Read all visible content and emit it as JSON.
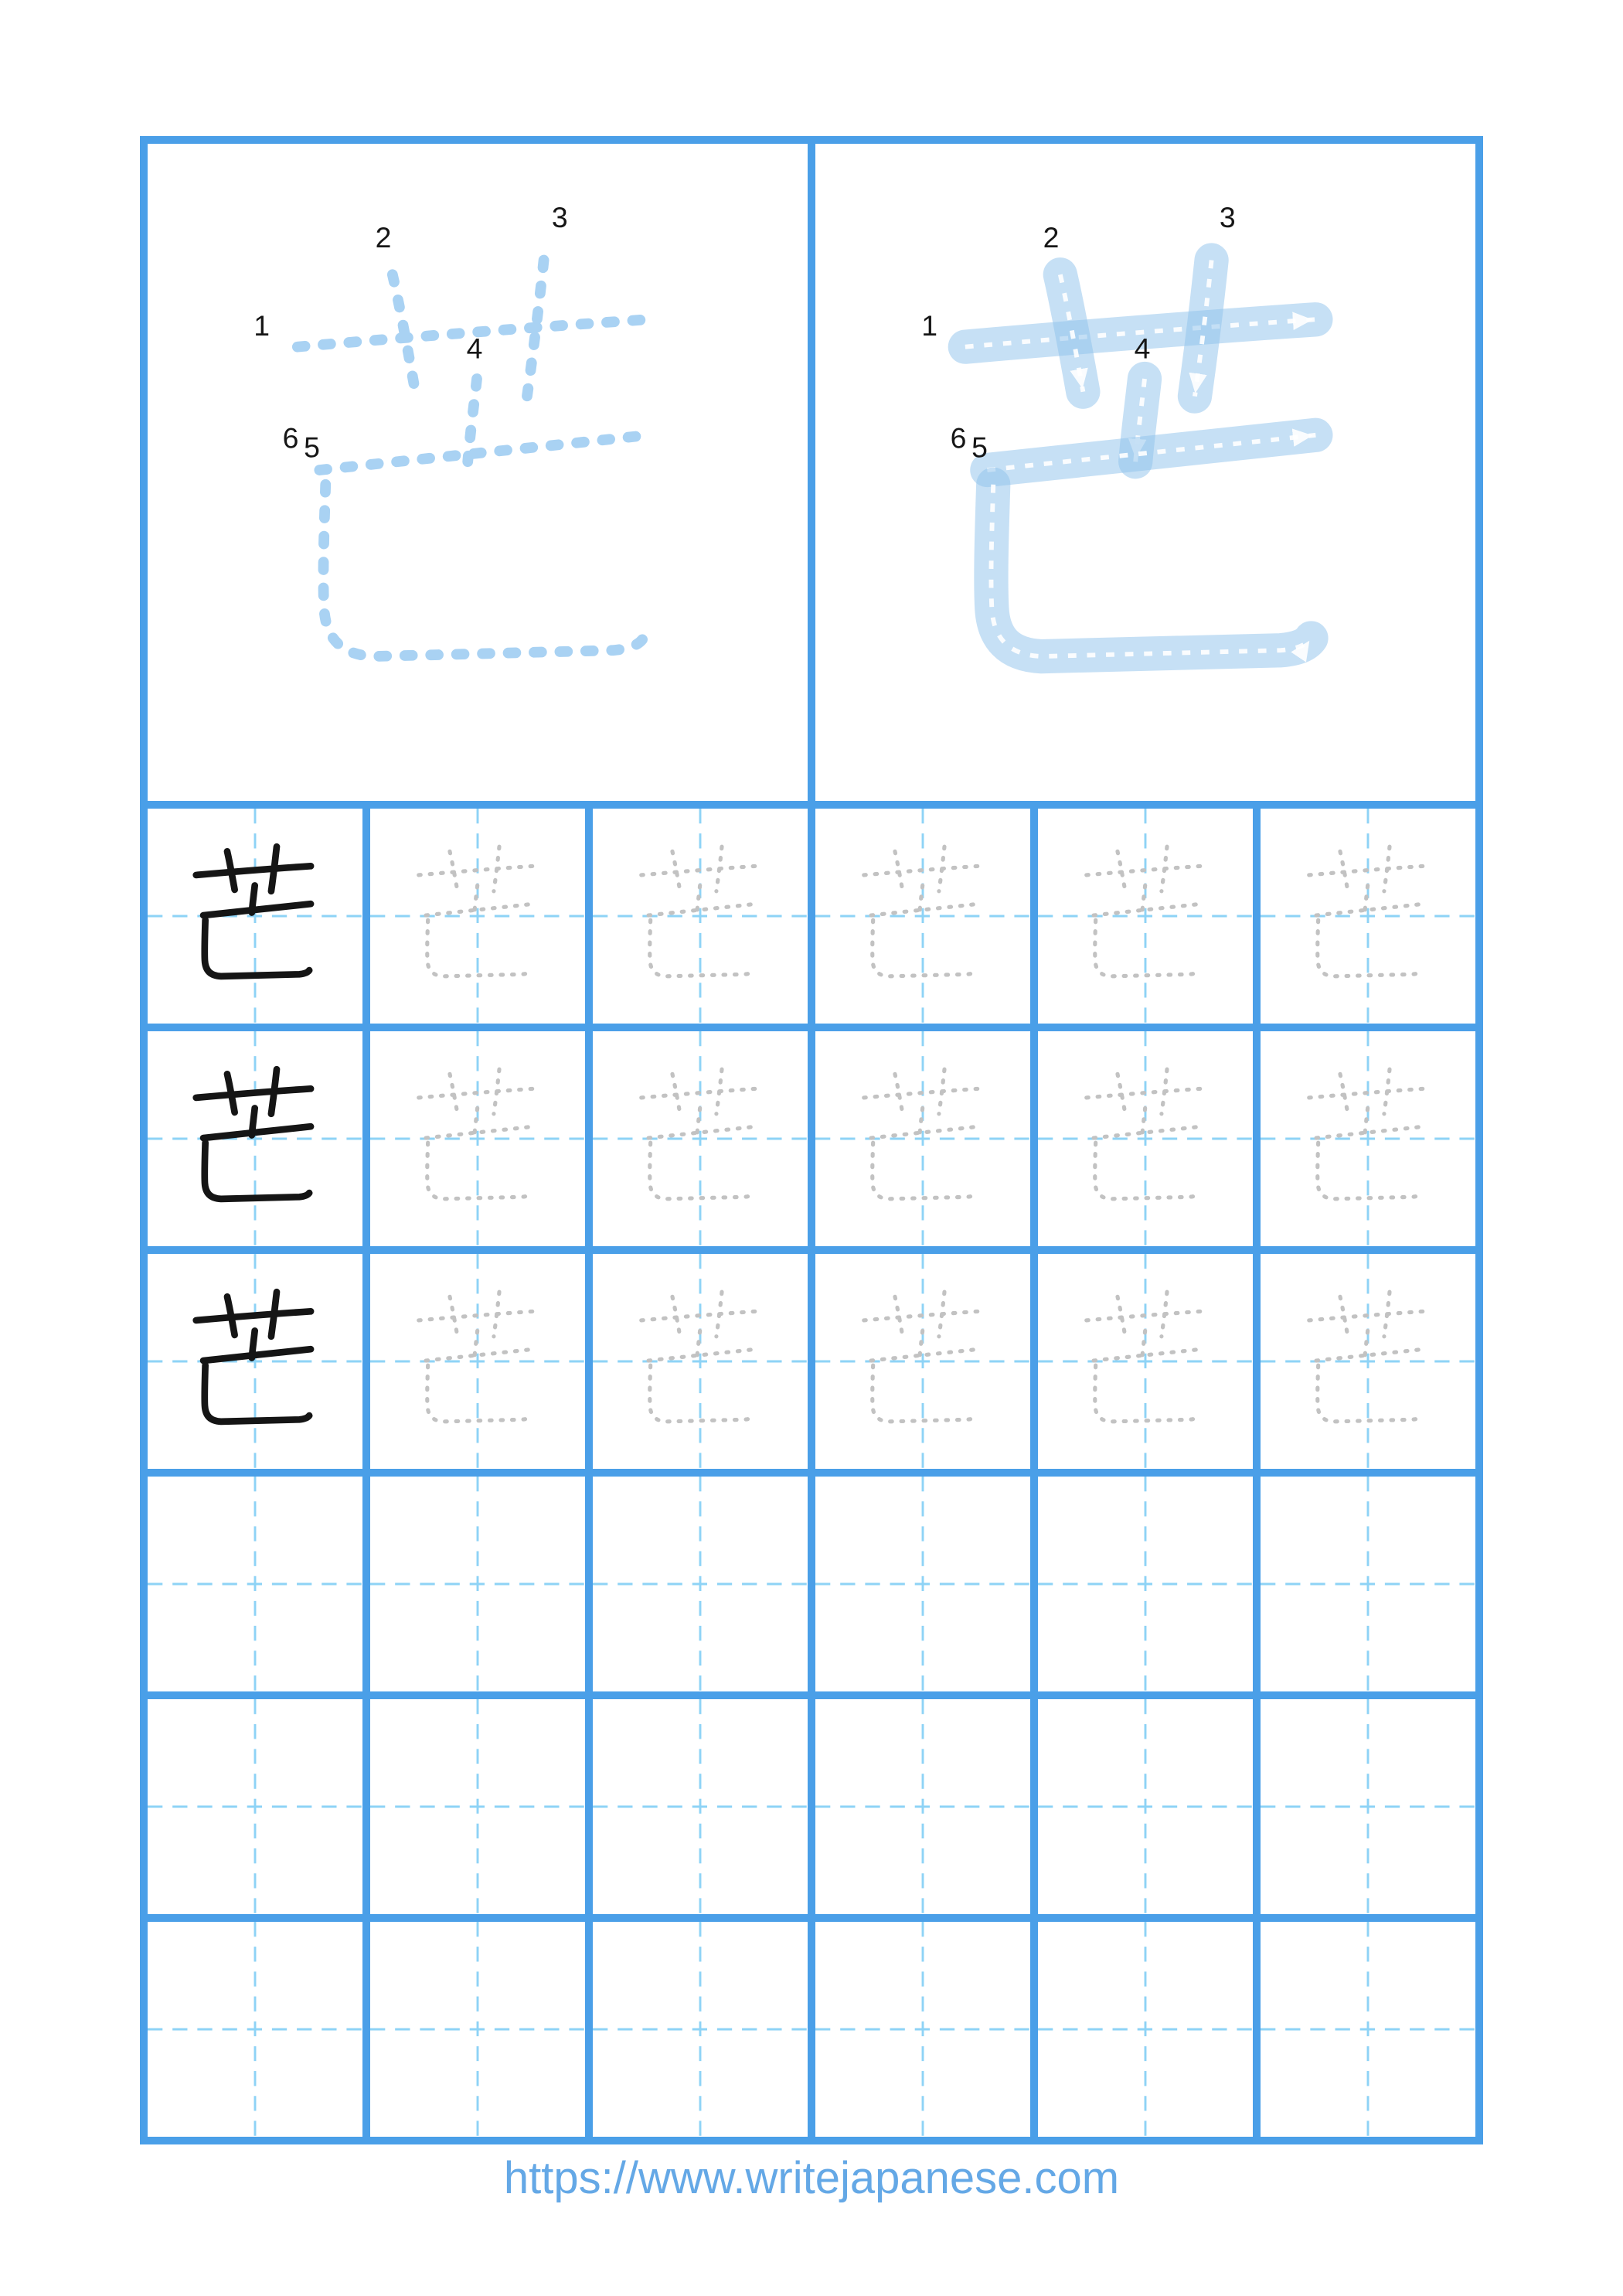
{
  "page": {
    "kanji": "芒",
    "url_text": "https://www.writejapanese.com"
  },
  "stroke_order": {
    "stroke_count": 6,
    "numbers": [
      "1",
      "2",
      "3",
      "4",
      "5",
      "6"
    ]
  },
  "practice_grid": {
    "rows": 6,
    "cols": 6,
    "example_rows_with_kanji": 3,
    "solid_kanji_column": 1
  },
  "colors": {
    "grid_blue": "#4a9fe8",
    "guide_blue": "#8ed3f6",
    "dashed_kanji_blue": "#a9d2f3",
    "traced_stroke_blue": "#8ec1ec",
    "trace_gray": "#c2c2c2",
    "ink_black": "#151515",
    "url_blue": "#64a8e6"
  }
}
